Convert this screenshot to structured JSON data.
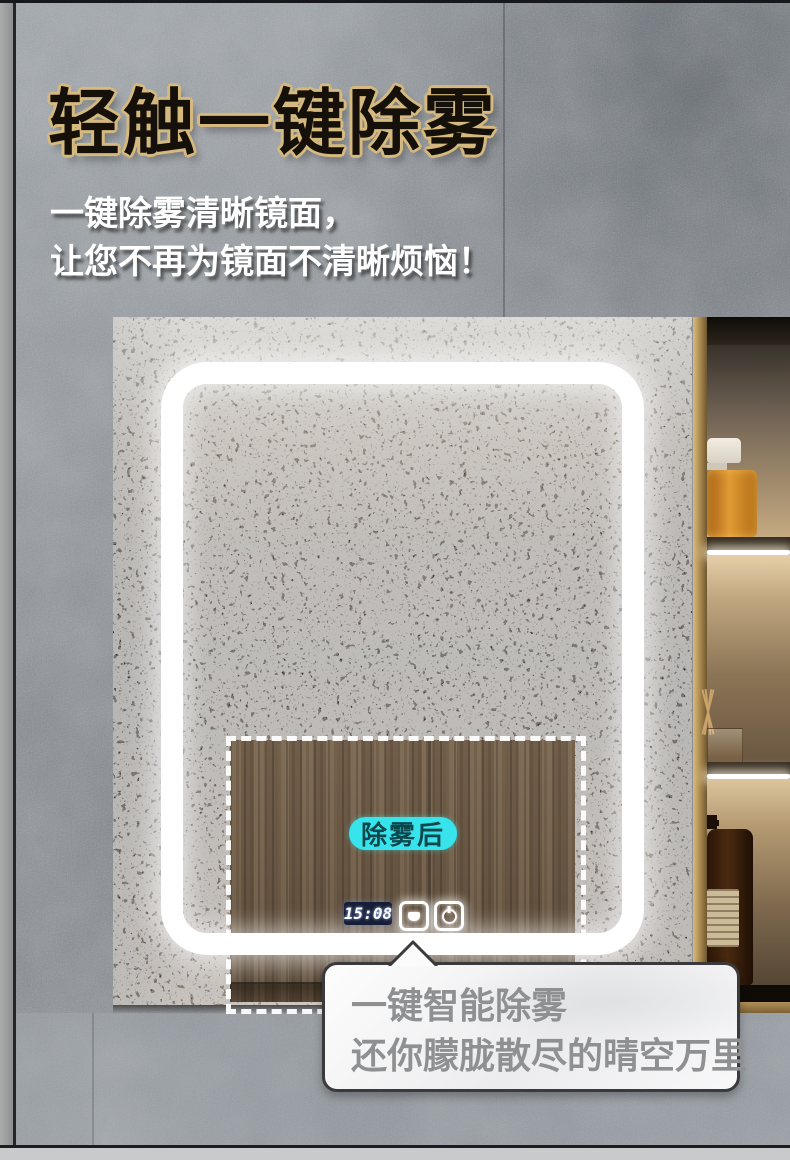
{
  "header": {
    "title": "轻触一键除雾",
    "subtitle_line1": "一键除雾清晰镜面，",
    "subtitle_line2": "让您不再为镜面不清晰烦恼！",
    "title_fill_color": "#15110a",
    "title_outline_color": "#d5b97e"
  },
  "mirror": {
    "defog_area_label": "除雾后",
    "defog_label_bg_color": "#38e4ec",
    "clock_time": "15:08",
    "clock_bg_color": "#161d36",
    "led_color": "#ffffff",
    "buttons": [
      {
        "icon": "defog-icon"
      },
      {
        "icon": "power-icon"
      }
    ]
  },
  "callout": {
    "line1": "一键智能除雾",
    "line2": "还你朦胧散尽的晴空万里",
    "text_color": "#8f9091"
  }
}
